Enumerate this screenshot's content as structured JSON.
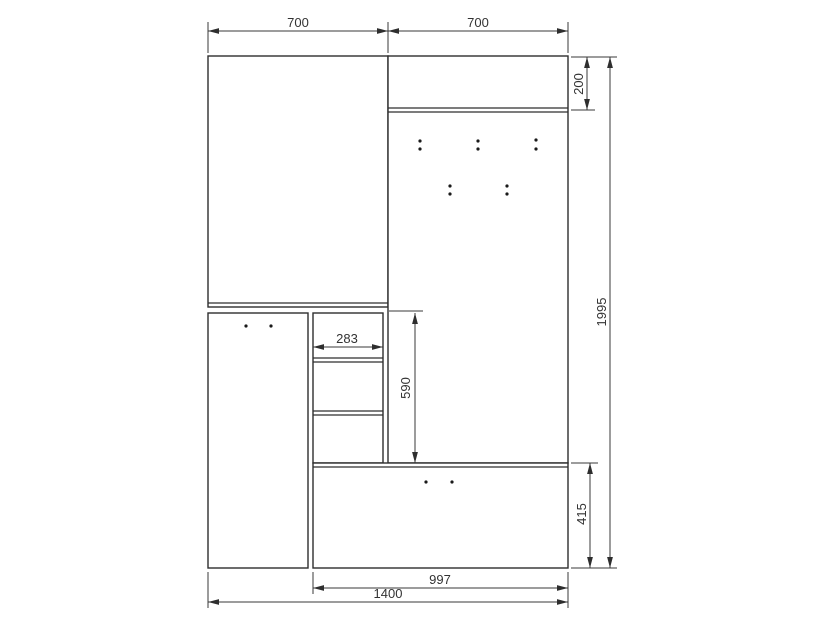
{
  "drawing": {
    "background": "#ffffff",
    "line_color": "#2e2e2e",
    "dim_line_color": "#3a3a3a",
    "text_color": "#333333",
    "panels": [
      {
        "name": "wardrobe-door-panel",
        "x": 208,
        "y": 56,
        "w": 180,
        "h": 251
      },
      {
        "name": "lower-left-door-panel",
        "x": 208,
        "y": 313,
        "w": 100,
        "h": 255
      },
      {
        "name": "open-shelf-unit",
        "x": 313,
        "y": 313,
        "w": 70,
        "h": 150
      },
      {
        "name": "coat-hook-back-panel",
        "x": 388,
        "y": 56,
        "w": 180,
        "h": 407
      },
      {
        "name": "bench-drawer-box",
        "x": 313,
        "y": 463,
        "w": 255,
        "h": 105
      }
    ],
    "inner_lines": [
      {
        "name": "wardrobe-bottom-edge-line",
        "x1": 208,
        "y1": 303,
        "x2": 388,
        "y2": 303
      },
      {
        "name": "top-shelf-edge-line-a",
        "x1": 388,
        "y1": 108,
        "x2": 568,
        "y2": 108
      },
      {
        "name": "top-shelf-edge-line-b",
        "x1": 388,
        "y1": 112,
        "x2": 568,
        "y2": 112
      },
      {
        "name": "shelf-1-line-a",
        "x1": 313,
        "y1": 358,
        "x2": 383,
        "y2": 358
      },
      {
        "name": "shelf-1-line-b",
        "x1": 313,
        "y1": 362,
        "x2": 383,
        "y2": 362
      },
      {
        "name": "shelf-2-line-a",
        "x1": 313,
        "y1": 411,
        "x2": 383,
        "y2": 411
      },
      {
        "name": "shelf-2-line-b",
        "x1": 313,
        "y1": 415,
        "x2": 383,
        "y2": 415
      },
      {
        "name": "bench-top-edge-line",
        "x1": 313,
        "y1": 467,
        "x2": 568,
        "y2": 467
      }
    ],
    "extension_lines": [
      {
        "x1": 208,
        "y1": 22,
        "x2": 208,
        "y2": 53
      },
      {
        "x1": 388,
        "y1": 22,
        "x2": 388,
        "y2": 53
      },
      {
        "x1": 568,
        "y1": 22,
        "x2": 568,
        "y2": 53
      },
      {
        "x1": 571,
        "y1": 57,
        "x2": 617,
        "y2": 57
      },
      {
        "x1": 571,
        "y1": 110,
        "x2": 595,
        "y2": 110
      },
      {
        "x1": 571,
        "y1": 463,
        "x2": 598,
        "y2": 463
      },
      {
        "x1": 571,
        "y1": 568,
        "x2": 617,
        "y2": 568
      },
      {
        "x1": 389,
        "y1": 311,
        "x2": 423,
        "y2": 311
      },
      {
        "x1": 208,
        "y1": 572,
        "x2": 208,
        "y2": 608
      },
      {
        "x1": 313,
        "y1": 572,
        "x2": 313,
        "y2": 594
      },
      {
        "x1": 568,
        "y1": 572,
        "x2": 568,
        "y2": 608
      }
    ],
    "dimensions": [
      {
        "name": "dim-width-left-700",
        "value": "700",
        "x1": 208,
        "y1": 31,
        "x2": 388,
        "y2": 31,
        "label_x": 298,
        "label_y": 27,
        "rotate": false
      },
      {
        "name": "dim-width-right-700",
        "value": "700",
        "x1": 388,
        "y1": 31,
        "x2": 568,
        "y2": 31,
        "label_x": 478,
        "label_y": 27,
        "rotate": false
      },
      {
        "name": "dim-top-shelf-height-200",
        "value": "200",
        "x1": 587,
        "y1": 57,
        "x2": 587,
        "y2": 110,
        "label_x": 583,
        "label_y": 84,
        "rotate": true
      },
      {
        "name": "dim-total-height-1995",
        "value": "1995",
        "x1": 610,
        "y1": 57,
        "x2": 610,
        "y2": 568,
        "label_x": 606,
        "label_y": 312,
        "rotate": true
      },
      {
        "name": "dim-shelf-width-283",
        "value": "283",
        "x1": 313,
        "y1": 347,
        "x2": 383,
        "y2": 347,
        "label_x": 347,
        "label_y": 343,
        "rotate": false
      },
      {
        "name": "dim-open-section-height-590",
        "value": "590",
        "x1": 415,
        "y1": 313,
        "x2": 415,
        "y2": 463,
        "label_x": 410,
        "label_y": 388,
        "rotate": true
      },
      {
        "name": "dim-bench-height-415",
        "value": "415",
        "x1": 590,
        "y1": 463,
        "x2": 590,
        "y2": 568,
        "label_x": 586,
        "label_y": 514,
        "rotate": true
      },
      {
        "name": "dim-bench-width-997",
        "value": "997",
        "x1": 313,
        "y1": 588,
        "x2": 568,
        "y2": 588,
        "label_x": 440,
        "label_y": 584,
        "rotate": false
      },
      {
        "name": "dim-total-width-1400",
        "value": "1400",
        "x1": 208,
        "y1": 602,
        "x2": 568,
        "y2": 602,
        "label_x": 388,
        "label_y": 598,
        "rotate": false
      }
    ],
    "dot_groups": [
      {
        "name": "left-door-handle-dots",
        "dots": [
          [
            246,
            326
          ],
          [
            271,
            326
          ]
        ]
      },
      {
        "name": "bench-handle-dots",
        "dots": [
          [
            426,
            482
          ],
          [
            452,
            482
          ]
        ]
      },
      {
        "name": "coat-hook-dots",
        "dots": [
          [
            420,
            141
          ],
          [
            420,
            149
          ],
          [
            478,
            141
          ],
          [
            478,
            149
          ],
          [
            536,
            140
          ],
          [
            536,
            149
          ],
          [
            450,
            186
          ],
          [
            450,
            194
          ],
          [
            507,
            186
          ],
          [
            507,
            194
          ]
        ]
      }
    ]
  }
}
